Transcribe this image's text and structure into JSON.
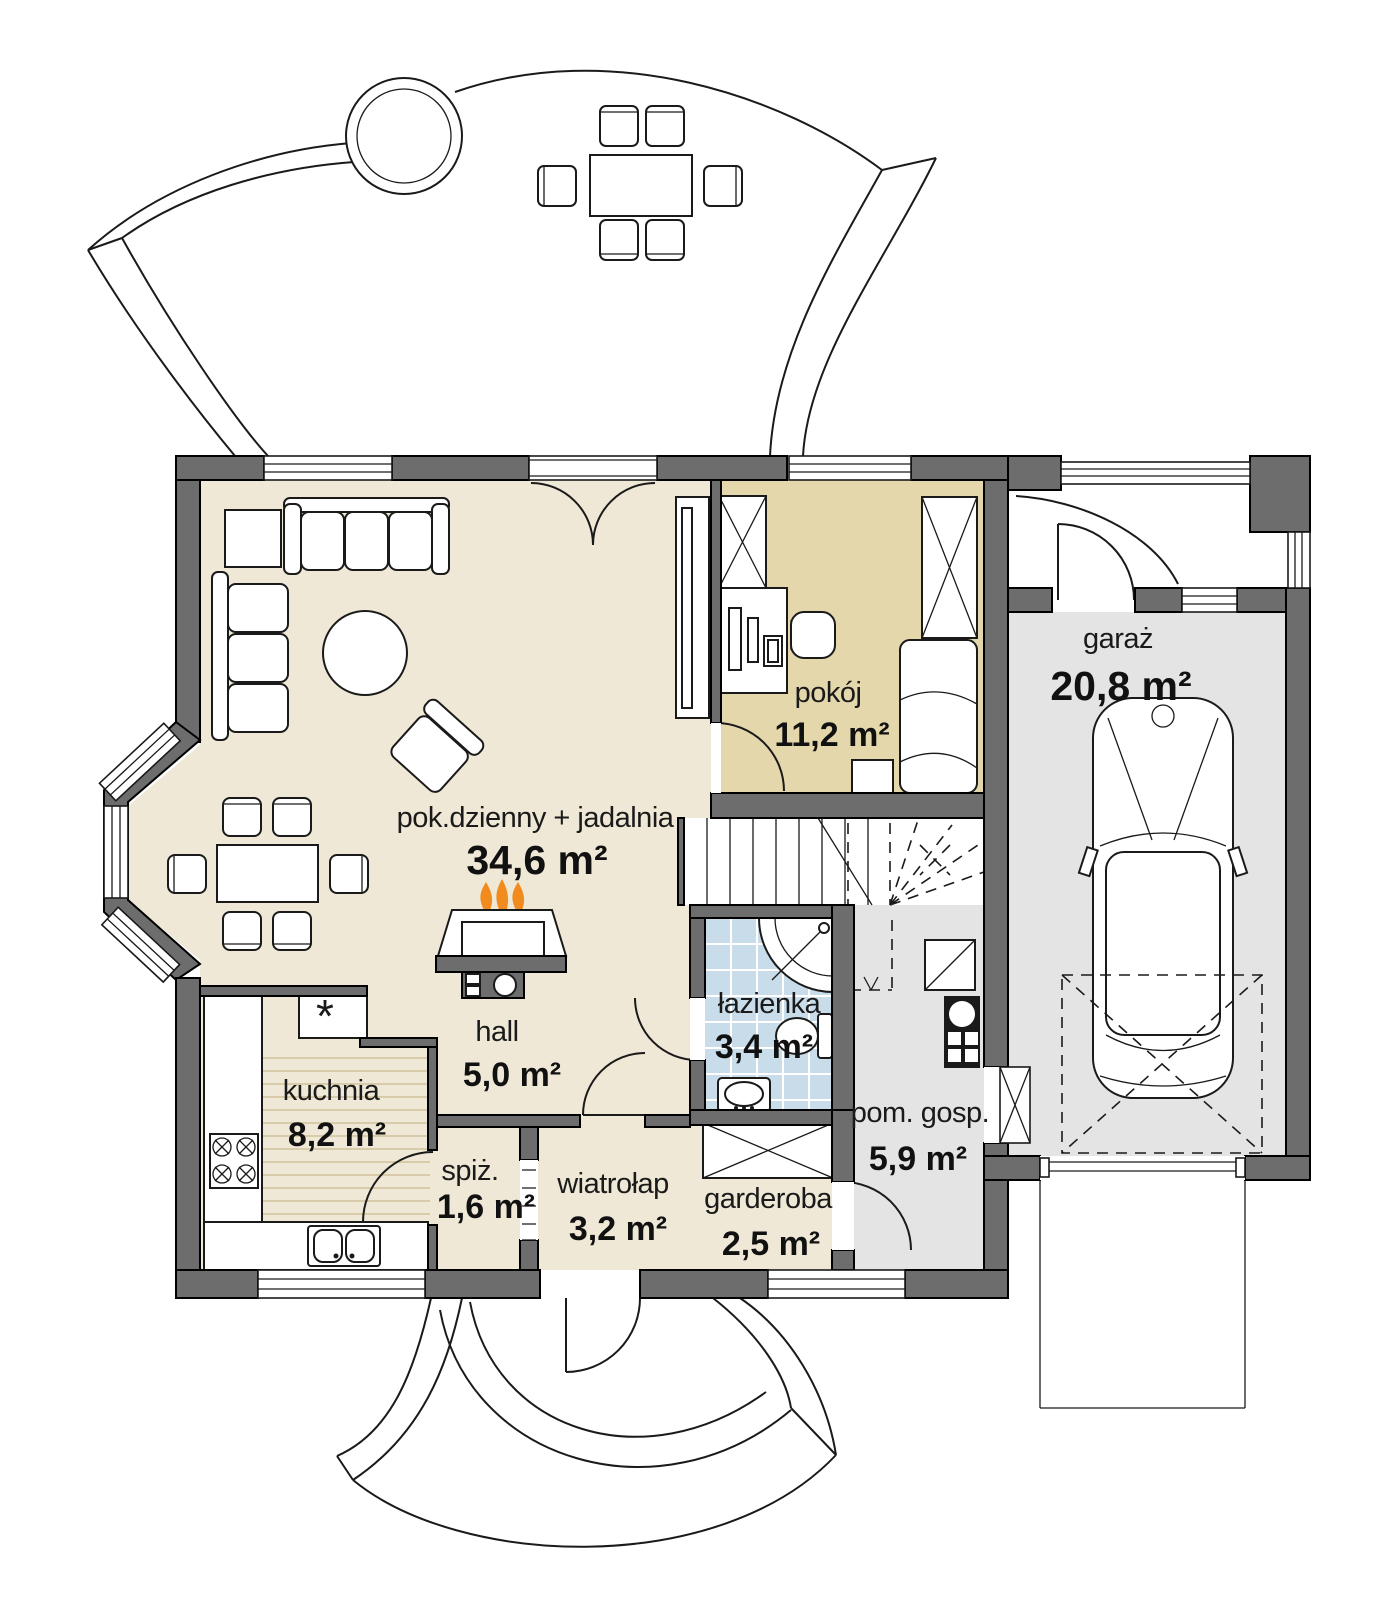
{
  "colors": {
    "wall": "#6d6d6d",
    "outline": "#1a1a1a",
    "floor_cream": "#efe8d6",
    "floor_tan": "#e4d7ac",
    "floor_tile_blue": "#c9dcea",
    "floor_gray": "#e4e4e4",
    "kitchen_stripe": "#d8cbaa",
    "flame_orange": "#f28b1d"
  },
  "rooms": {
    "living": {
      "name": "pok.dzienny + jadalnia",
      "area": "34,6 m²"
    },
    "pokoj": {
      "name": "pokój",
      "area": "11,2 m²"
    },
    "garage": {
      "name": "garaż",
      "area": "20,8 m²"
    },
    "kitchen": {
      "name": "kuchnia",
      "area": "8,2 m²"
    },
    "hall": {
      "name": "hall",
      "area": "5,0 m²"
    },
    "bathroom": {
      "name": "łazienka",
      "area": "3,4 m²"
    },
    "pantry": {
      "name": "spiż.",
      "area": "1,6 m²"
    },
    "vestibule": {
      "name": "wiatrołap",
      "area": "3,2 m²"
    },
    "wardrobe": {
      "name": "garderoba",
      "area": "2,5 m²"
    },
    "utility": {
      "name": "pom. gosp.",
      "area": "5,9 m²"
    }
  },
  "symbols": {
    "fridge_mark": "*"
  }
}
